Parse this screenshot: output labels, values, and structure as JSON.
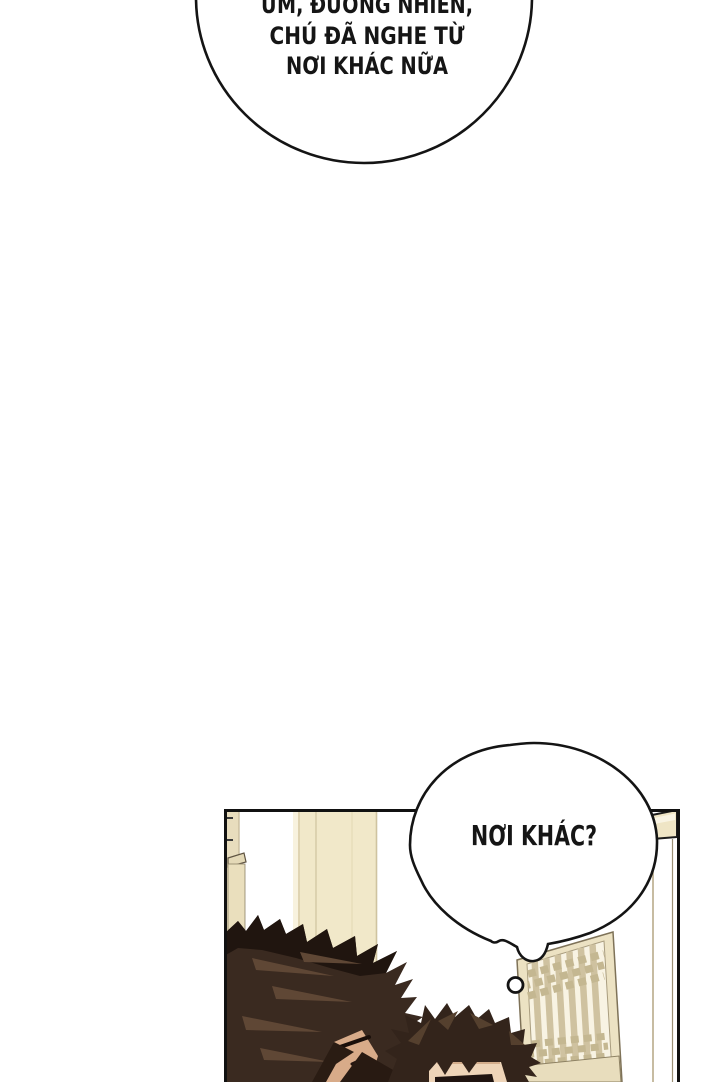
{
  "page": {
    "kind": "webtoon comic page",
    "background": "#ffffff"
  },
  "speech_bubbles": {
    "top": {
      "line1": "ỪM, ĐƯƠNG NHIÊN,",
      "line2": "CHÚ ĐÃ NGHE TỪ",
      "line3": "NƠI KHÁC NỮA"
    },
    "bottom": {
      "text": "NƠI KHÁC?"
    }
  },
  "colors": {
    "ink": "#141414",
    "panel_border": "#111111",
    "bubble_fill": "#ffffff",
    "wood_light": "#f1e8c9",
    "wood_pale": "#f8f2de",
    "wood_mid": "#e8ddbd",
    "wood_seam": "#d8cca9",
    "door_frame": "#ece2c3",
    "door_inner": "#f8f3e3",
    "door_slat": "#cfc2a0",
    "door_weave": "#c4b791",
    "hair_left_base": "#3a2a20",
    "hair_left_shadow": "#20150f",
    "hair_left_highlight": "#5f4735",
    "hair_right_base": "#33241b",
    "hair_right_highlight": "#55402e",
    "skin_left": "#d8ab89",
    "skin_right": "#eed4b8"
  }
}
